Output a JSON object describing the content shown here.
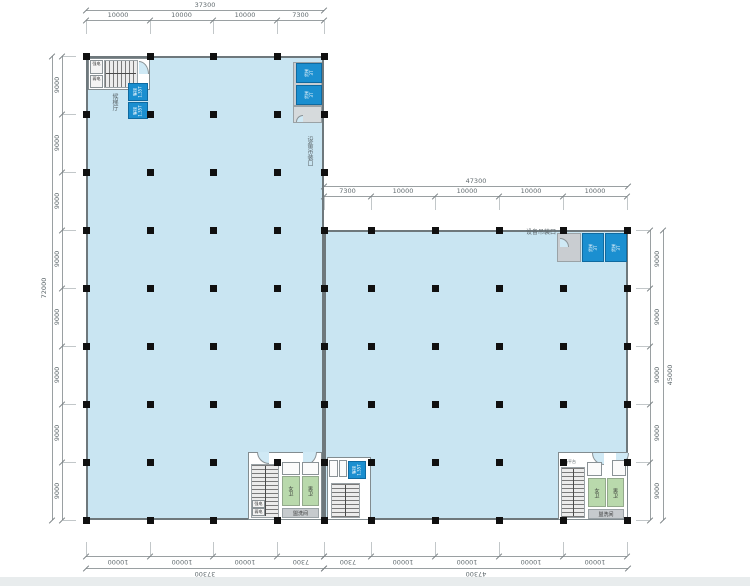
{
  "labels": {
    "lobby": "候梯厅",
    "passenger_line1": "客梯",
    "passenger_line2": "1.35T",
    "freight_line1": "货梯",
    "freight_line2": "3T",
    "hoist": "设备吊装口",
    "elec_strong": "强电",
    "elec_weak": "弱电",
    "wc_female": "女卫",
    "wc_male": "男卫",
    "washroom": "盥洗间",
    "equip_platform": "设备平台"
  },
  "dimensions": {
    "top_left": {
      "total": "37300",
      "segments": [
        "10000",
        "10000",
        "10000",
        "7300"
      ]
    },
    "top_right": {
      "total": "47300",
      "segments": [
        "7300",
        "10000",
        "10000",
        "10000",
        "10000"
      ]
    },
    "bottom_left": {
      "total": "37300",
      "segments": [
        "10000",
        "10000",
        "10000",
        "7300"
      ]
    },
    "bottom_right": {
      "total": "47300",
      "segments": [
        "7300",
        "10000",
        "10000",
        "10000",
        "10000"
      ]
    },
    "left": {
      "total": "72000",
      "segments": [
        "9000",
        "9000",
        "9000",
        "9000",
        "9000",
        "9000",
        "9000",
        "9000"
      ]
    },
    "right": {
      "total": "45000",
      "segments": [
        "9000",
        "9000",
        "9000",
        "9000",
        "9000"
      ]
    }
  },
  "colors": {
    "floor": "#c9e5f2",
    "elevator_blue": "#1b8fd0",
    "toilet_green": "#b9d9ac",
    "shaft_gray": "#c9cdd1",
    "column_black": "#101010",
    "wall_gray": "#6e787c",
    "dim_gray": "#9aa0a2"
  }
}
